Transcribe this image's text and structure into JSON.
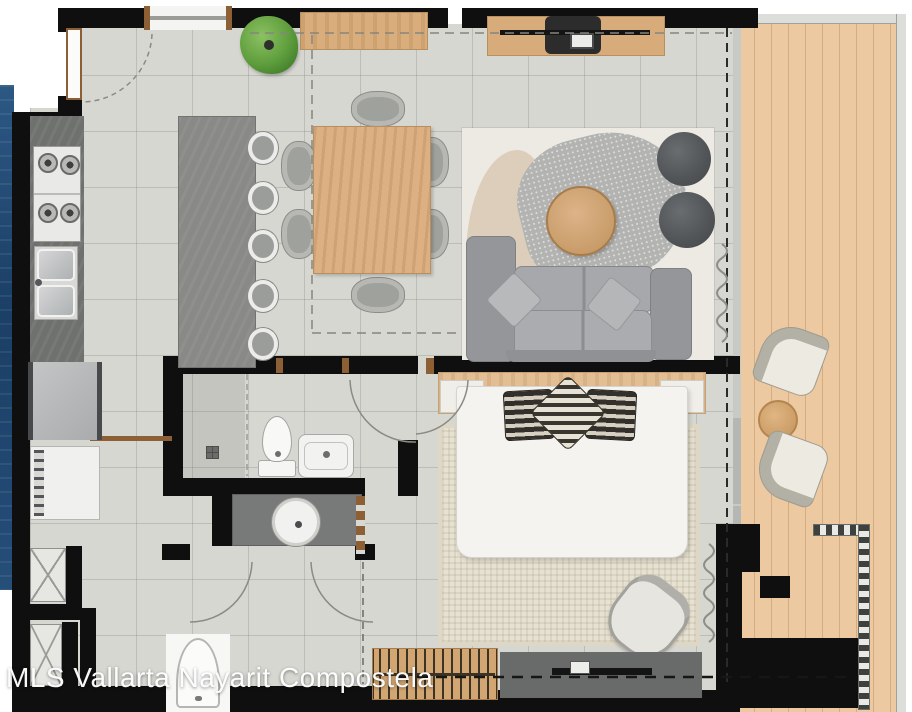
{
  "watermark": {
    "text": "MLS Vallarta Nayarit Compostela"
  },
  "palette": {
    "wall_black": "#0f0f0f",
    "floor_tile_gray": "#d6d7d1",
    "terrace_wood": "#ecc9a1",
    "furniture_wood": "#d9ad7c",
    "kitchen_counter_gray": "#6f716f",
    "island_stone_gray": "#898a87",
    "sofa_gray": "#9b9da0",
    "pouf_charcoal": "#515457",
    "exterior_accent_blue": "#24507c",
    "door_frame_brown": "#8d5f35",
    "bed_linen_white": "#f4f3ef",
    "bedroom_rug_beige": "#e7e1d2",
    "plant_green": "#5f9e40"
  }
}
